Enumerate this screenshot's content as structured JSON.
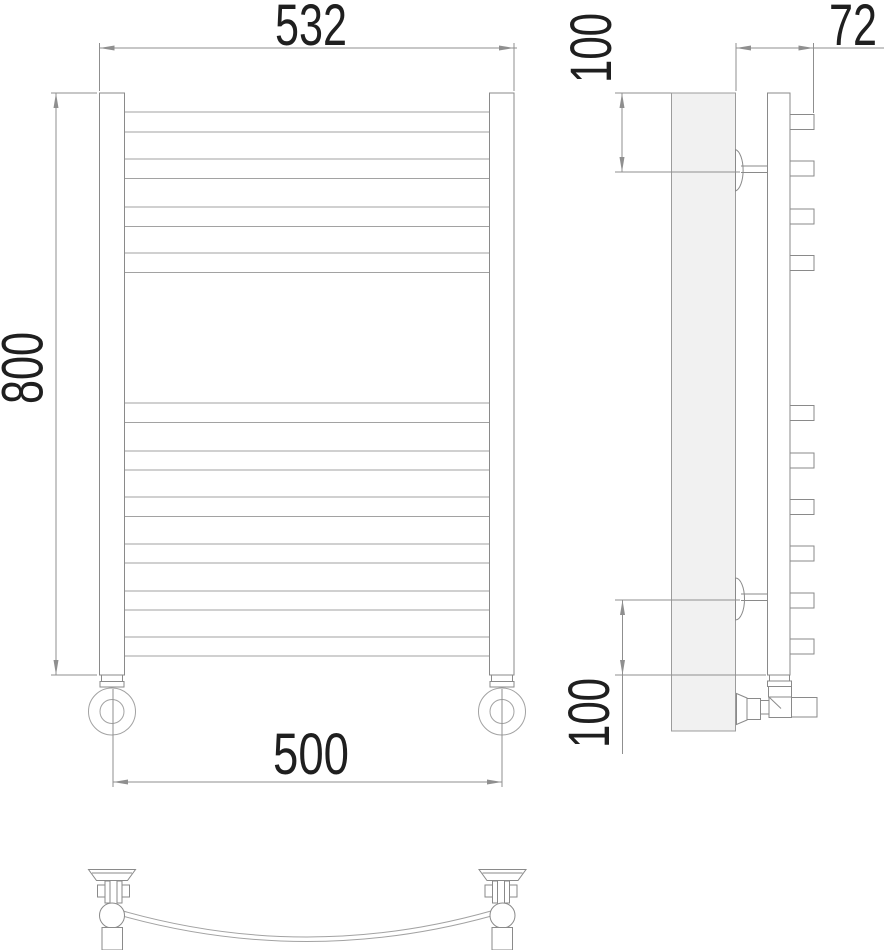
{
  "document_type": "technical-drawing",
  "subject": "curved ladder towel radiator, three orthographic views",
  "colors": {
    "background": "#ffffff",
    "line": "#8a8a8a",
    "light_line": "#a2a2a2",
    "text": "#1f1f1f",
    "wall_panel_fill": "#f1f1f1"
  },
  "dimensions": {
    "overall_width": {
      "value": "532",
      "orientation": "horizontal",
      "location": "top of front view"
    },
    "overall_height": {
      "value": "800",
      "orientation": "vertical",
      "location": "left of front view"
    },
    "axis_spacing": {
      "value": "500",
      "orientation": "horizontal",
      "location": "bottom of front view"
    },
    "wall_offset_depth": {
      "value": "72",
      "orientation": "horizontal",
      "location": "top of side view"
    },
    "top_bracket_offset": {
      "value": "100",
      "orientation": "vertical",
      "location": "upper left of side view"
    },
    "bottom_bracket_offset": {
      "value": "100",
      "orientation": "vertical",
      "location": "lower left of side view"
    }
  },
  "drawing": {
    "front": {
      "post_top": 93,
      "post_bottom": 675,
      "posts": [
        {
          "x": 99.5,
          "w": 25
        },
        {
          "x": 489.5,
          "w": 24.5
        }
      ],
      "rung_span_x": [
        124.5,
        489.5
      ],
      "rungs_y": [
        [
          112,
          132
        ],
        [
          159,
          178.5
        ],
        [
          207,
          226.5
        ],
        [
          253,
          272.5
        ],
        [
          403,
          422.5
        ],
        [
          451,
          470
        ],
        [
          497,
          516.5
        ],
        [
          544,
          563
        ],
        [
          591,
          610
        ],
        [
          637,
          656
        ]
      ],
      "feet_cx": [
        112,
        502
      ],
      "foot": {
        "cy": 711.5,
        "outer_r": 23.5,
        "inner_r": 12,
        "neck_y": 675,
        "collar_y": 681.5
      }
    },
    "side": {
      "stub_x": 790,
      "stub_w": 24,
      "stub_h": 15,
      "stub_centers_y": [
        122,
        168.5,
        216.5,
        263,
        413,
        460.5,
        507,
        553.5,
        600.5,
        646.5
      ]
    },
    "top": {
      "fitting_cx": [
        112,
        502.5
      ],
      "mirror": [
        false,
        true
      ],
      "rail_circle": {
        "cy": 915.5,
        "r": 12.5
      }
    }
  }
}
